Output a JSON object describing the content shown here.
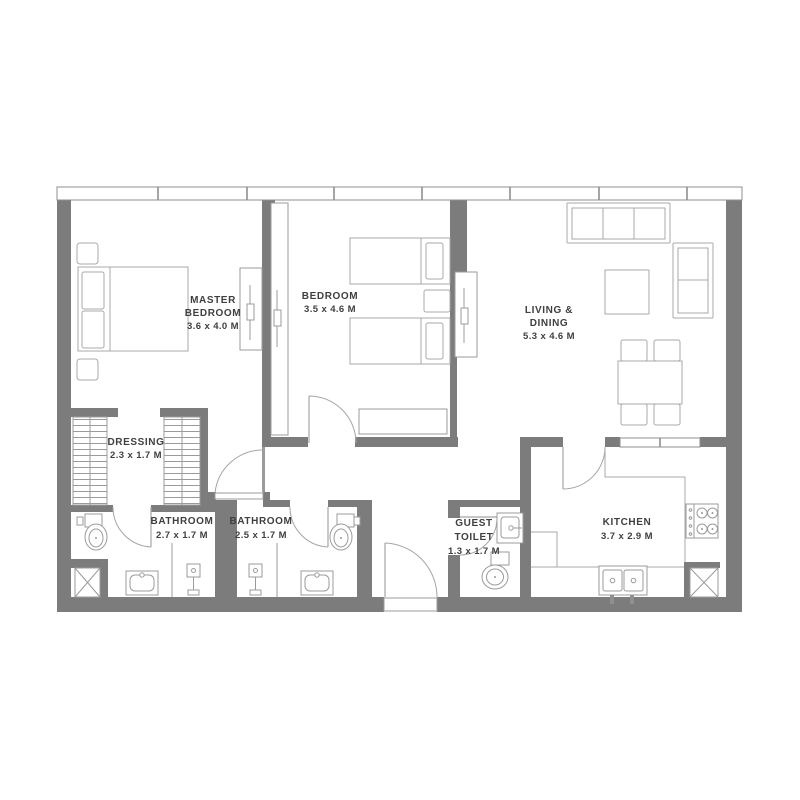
{
  "page": {
    "background": "#ffffff",
    "type": "apartment-floor-plan"
  },
  "palette": {
    "wall": "#7c7c7c",
    "thin_wall": "#9b9b9b",
    "furniture_line": "#a9a9a9",
    "fixture_line": "#9b9b9b",
    "label_text": "#3f3f3f"
  },
  "rooms": {
    "master_bedroom": {
      "name_line1": "MASTER",
      "name_line2": "BEDROOM",
      "dimensions": "3.6 x 4.0 M"
    },
    "bedroom": {
      "name_line1": "BEDROOM",
      "dimensions": "3.5 x 4.6 M"
    },
    "living_dining": {
      "name_line1": "LIVING &",
      "name_line2": "DINING",
      "dimensions": "5.3 x 4.6 M"
    },
    "dressing": {
      "name_line1": "DRESSING",
      "dimensions": "2.3 x 1.7 M"
    },
    "bathroom_master": {
      "name_line1": "BATHROOM",
      "dimensions": "2.7 x 1.7 M"
    },
    "bathroom_shared": {
      "name_line1": "BATHROOM",
      "dimensions": "2.5 x 1.7 M"
    },
    "guest_toilet": {
      "name_line1": "GUEST",
      "name_line2": "TOILET",
      "dimensions": "1.3 x 1.7 M"
    },
    "kitchen": {
      "name_line1": "KITCHEN",
      "dimensions": "3.7 x 2.9 M"
    }
  },
  "fixtures": [
    "double-bed",
    "twin-beds",
    "nightstands",
    "sliding-wardrobes",
    "shelved-wardrobes",
    "hanging-closet",
    "sofa-3-seat",
    "loveseat",
    "coffee-table",
    "dining-table-4-chairs",
    "toilets",
    "vanity-sinks",
    "showers",
    "stove-4-burner",
    "kitchen-double-sink",
    "service-shafts",
    "swing-doors",
    "window-band"
  ]
}
